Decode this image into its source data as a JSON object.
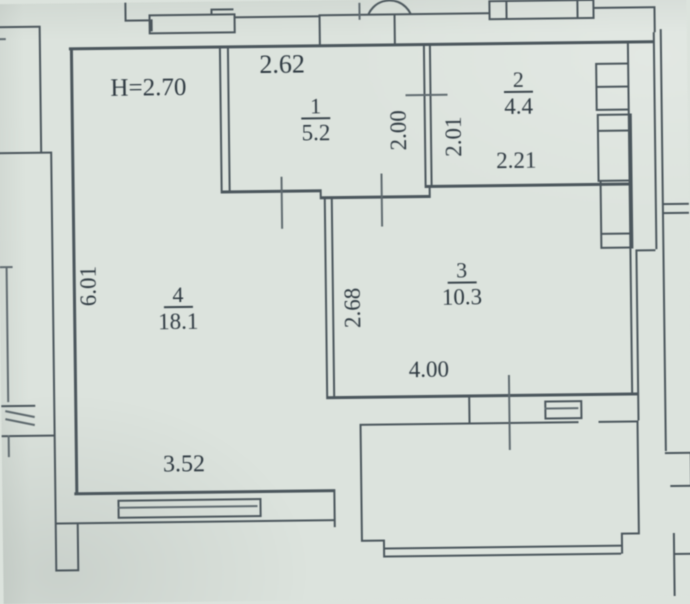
{
  "plan": {
    "type": "apartment floor plan (scanned BTI drawing)",
    "ceiling_height": "H=2.70",
    "rooms": [
      {
        "number": "1",
        "area": "5.2"
      },
      {
        "number": "2",
        "area": "4.4"
      },
      {
        "number": "3",
        "area": "10.3"
      },
      {
        "number": "4",
        "area": "18.1"
      }
    ],
    "dimensions": {
      "room1_width": "2.62",
      "room1_depth": "2.00",
      "room2_depth": "2.01",
      "room2_width": "2.21",
      "room3_depth": "2.68",
      "room3_width": "4.00",
      "room4_depth": "6.01",
      "room4_width": "3.52"
    },
    "colors": {
      "paper": "#dce3dd",
      "ink": "#39444b"
    }
  }
}
